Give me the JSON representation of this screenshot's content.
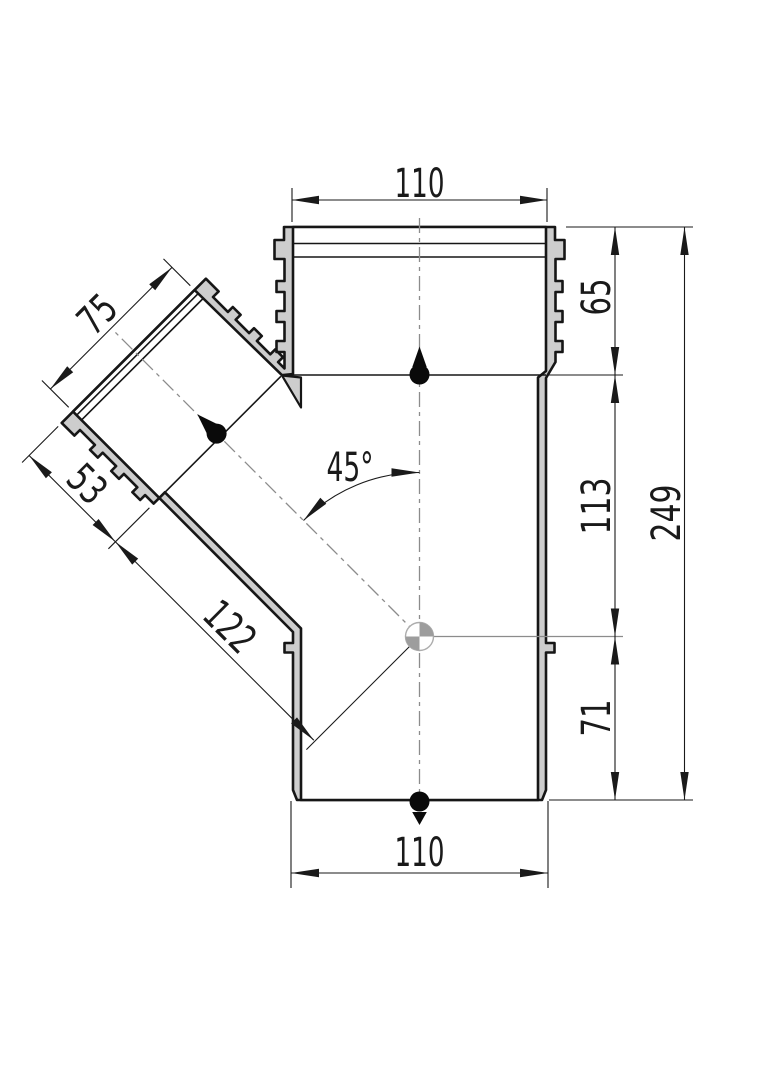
{
  "drawing": {
    "title": "45-degree branch pipe fitting section drawing",
    "dimensions": {
      "top_width": "110",
      "socket_depth_right": "65",
      "center_to_socket": "113",
      "bottom_to_center": "71",
      "overall_height": "249",
      "bottom_width": "110",
      "branch_diameter": "75",
      "branch_socket_depth": "53",
      "branch_center_length": "122",
      "branch_angle": "45°"
    },
    "colors": {
      "background": "#ffffff",
      "wall_fill": "#cdcdcd",
      "outline": "#161616",
      "dimension_lines": "#1a1a1a",
      "centerline": "#8c8c8c",
      "center_marker_fill": "#9d9d9d"
    }
  }
}
